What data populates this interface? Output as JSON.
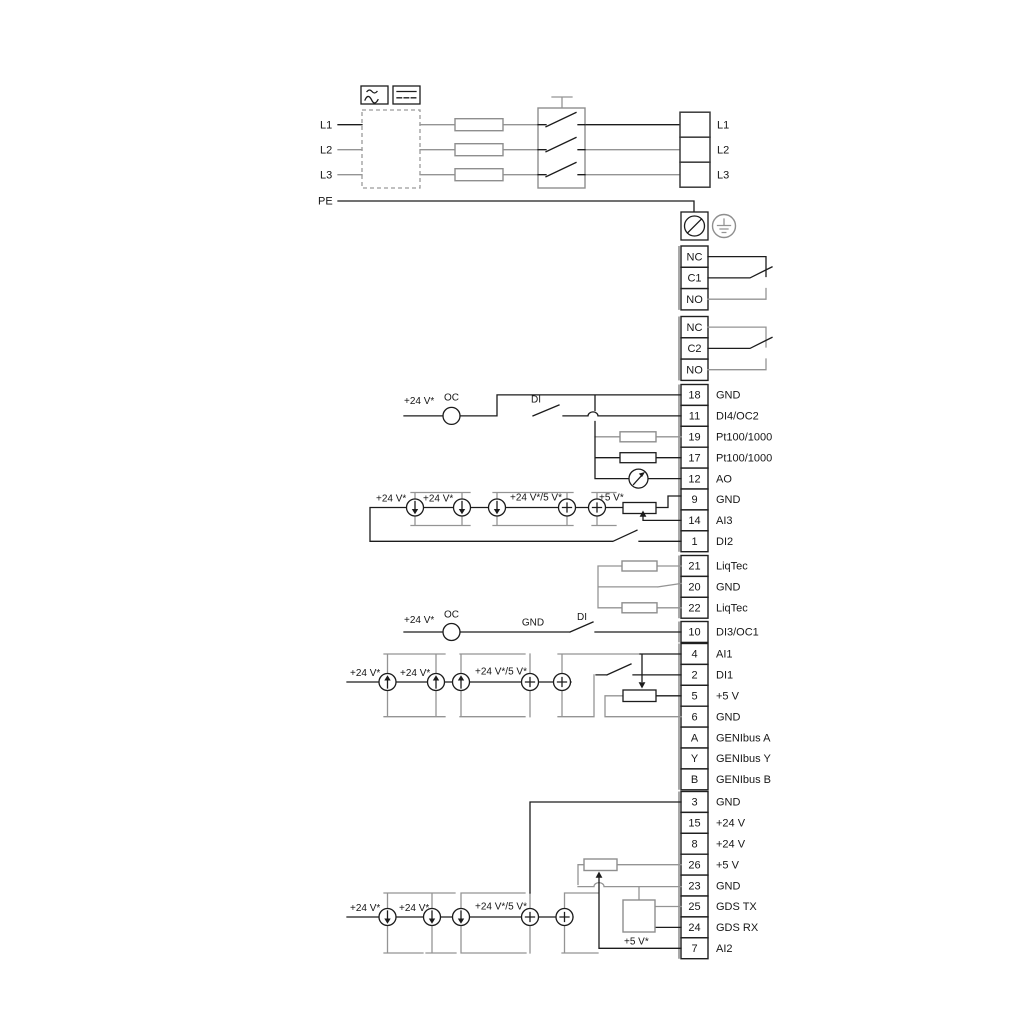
{
  "pwr": {
    "left": [
      {
        "l": "L1"
      },
      {
        "l": "L2"
      },
      {
        "l": "L3"
      },
      {
        "l": "PE"
      }
    ],
    "right": [
      {
        "l": "L1"
      },
      {
        "l": "L2"
      },
      {
        "l": "L3"
      }
    ]
  },
  "r1": [
    {
      "t": "NC"
    },
    {
      "t": "C1"
    },
    {
      "t": "NO"
    }
  ],
  "r2": [
    {
      "t": "NC"
    },
    {
      "t": "C2"
    },
    {
      "t": "NO"
    }
  ],
  "s1": [
    {
      "n": "18",
      "l": "GND"
    },
    {
      "n": "11",
      "l": "DI4/OC2"
    },
    {
      "n": "19",
      "l": "Pt100/1000"
    },
    {
      "n": "17",
      "l": "Pt100/1000"
    },
    {
      "n": "12",
      "l": "AO"
    },
    {
      "n": "9",
      "l": "GND"
    },
    {
      "n": "14",
      "l": "AI3"
    },
    {
      "n": "1",
      "l": "DI2"
    }
  ],
  "s2": [
    {
      "n": "21",
      "l": "LiqTec"
    },
    {
      "n": "20",
      "l": "GND"
    },
    {
      "n": "22",
      "l": "LiqTec"
    }
  ],
  "s3": [
    {
      "n": "10",
      "l": "DI3/OC1"
    }
  ],
  "s4": [
    {
      "n": "4",
      "l": "AI1"
    },
    {
      "n": "2",
      "l": "DI1"
    },
    {
      "n": "5",
      "l": "+5 V"
    },
    {
      "n": "6",
      "l": "GND"
    },
    {
      "n": "A",
      "l": "GENIbus A"
    },
    {
      "n": "Y",
      "l": "GENIbus Y"
    },
    {
      "n": "B",
      "l": "GENIbus B"
    }
  ],
  "s5": [
    {
      "n": "3",
      "l": "GND"
    },
    {
      "n": "15",
      "l": "+24 V"
    },
    {
      "n": "8",
      "l": "+24 V"
    },
    {
      "n": "26",
      "l": "+5 V"
    },
    {
      "n": "23",
      "l": "GND"
    },
    {
      "n": "25",
      "l": "GDS TX"
    },
    {
      "n": "24",
      "l": "GDS RX"
    },
    {
      "n": "7",
      "l": "AI2"
    }
  ],
  "ann": {
    "v24": "+24 V*",
    "v245": "+24 V*/5 V*",
    "v5": "+5 V*",
    "oc": "OC",
    "di": "DI",
    "gnd": "GND"
  },
  "colors": {
    "line": "#1c1c1c",
    "line_gray": "#949494"
  }
}
